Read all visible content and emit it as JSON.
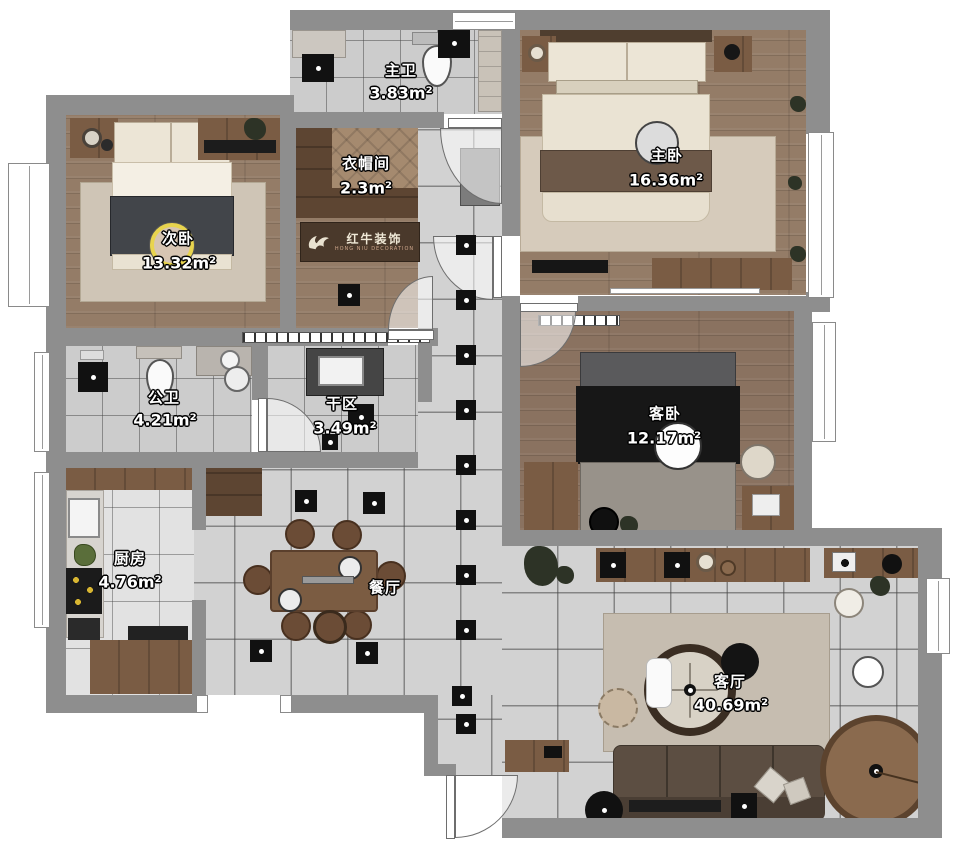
{
  "logo": {
    "brand": "红牛装饰",
    "subtitle": "HONG NIU DECORATION"
  },
  "rooms": {
    "master_bath": {
      "label": "主卫",
      "area": "3.83m²"
    },
    "cloakroom": {
      "label": "衣帽间",
      "area": "2.3m²"
    },
    "master_bedroom": {
      "label": "主卧",
      "area": "16.36m²"
    },
    "second_bedroom": {
      "label": "次卧",
      "area": "13.32m²"
    },
    "public_bath": {
      "label": "公卫",
      "area": "4.21m²"
    },
    "dry_area": {
      "label": "干区",
      "area": "3.49m²"
    },
    "guest_bedroom": {
      "label": "客卧",
      "area": "12.17m²"
    },
    "kitchen": {
      "label": "厨房",
      "area": "4.76m²"
    },
    "dining": {
      "label": "餐厅"
    },
    "living": {
      "label": "客厅",
      "area": "40.69m²"
    }
  },
  "colors": {
    "wall": "#8e8e8e",
    "wood_floor": "#947c67",
    "wood_floor_dark": "#8a7260",
    "tile_floor": "#d2d2d2",
    "cabinet_wood": "#7a5c44",
    "accent_ring": "#e8d44e",
    "logo_bg": "#4a392b",
    "logo_text": "#efe8d6"
  }
}
